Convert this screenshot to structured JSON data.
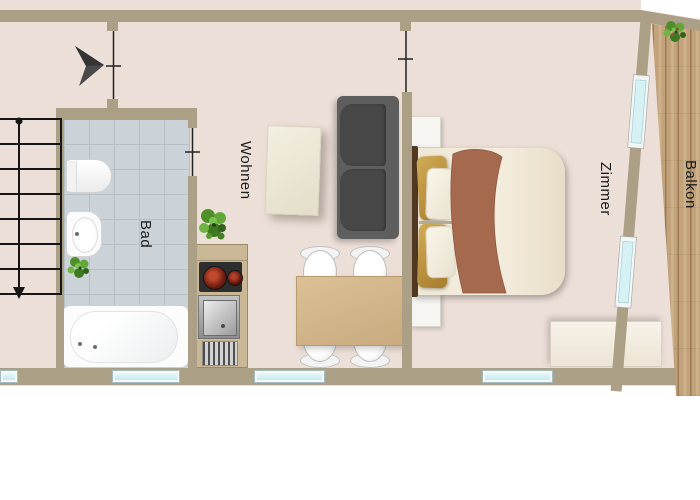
{
  "rooms": [
    {
      "id": "bad",
      "label": "Bad"
    },
    {
      "id": "wohnen",
      "label": "Wohnen"
    },
    {
      "id": "zimmer",
      "label": "Zimmer"
    },
    {
      "id": "balkon",
      "label": "Balkon"
    }
  ],
  "fixtures": {
    "bad": [
      "bathtub",
      "toilet",
      "washbasin",
      "plant"
    ],
    "wohnen": [
      "kitchen-counter",
      "stove",
      "sink",
      "coffee-table",
      "sofa",
      "dining-table",
      "chairs",
      "plant"
    ],
    "zimmer": [
      "double-bed",
      "nightstands",
      "sideboard"
    ],
    "balkon": [
      "plant"
    ]
  },
  "symbols": [
    "north-arrow",
    "stairs",
    "door-opening-markers",
    "windows"
  ],
  "colors": {
    "wall": "#ab9f86",
    "floor": "#ecdfd7",
    "tile": "#cbd2d8",
    "grout": "#b7bfc7",
    "wood": "#c1a27a",
    "wood-plank": "#9c7b53",
    "glass": "#d6f1f4",
    "sofa": "#5e5e5e",
    "cushion": "#484848",
    "counter": "#c9b795",
    "headboard": "#503823",
    "blanket": "#a5694e",
    "plant": "#4f8f2a",
    "label": "#1b1b1b",
    "outside": "#ffffff"
  }
}
